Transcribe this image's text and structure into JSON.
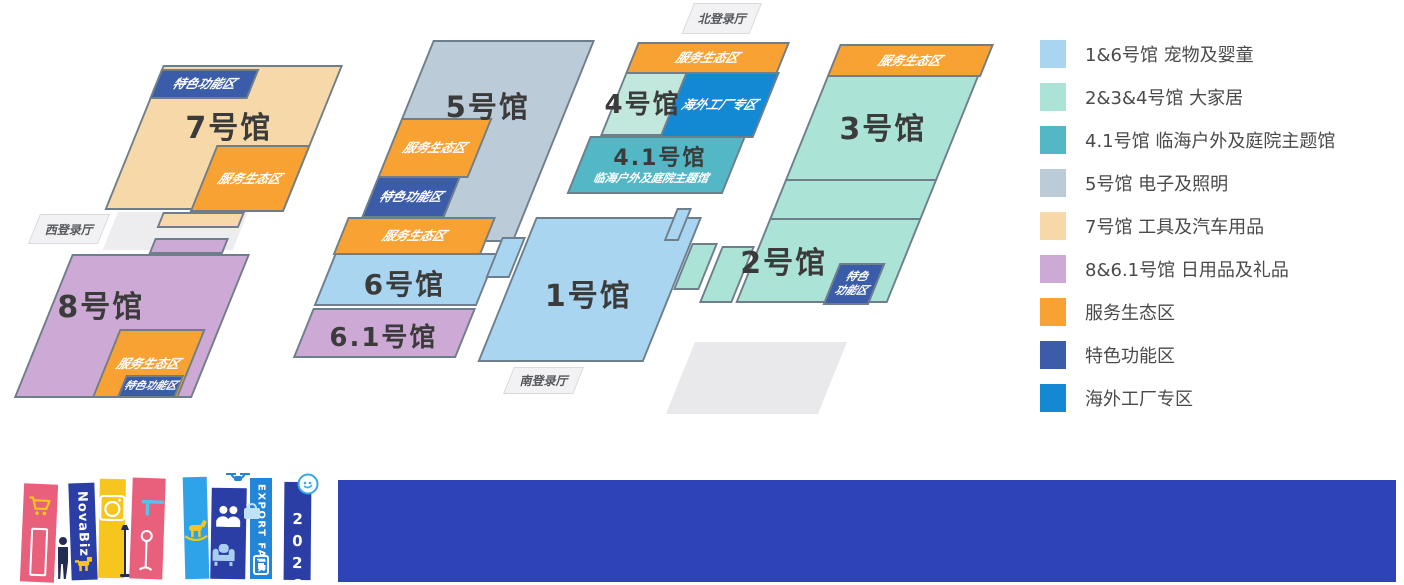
{
  "map": {
    "entrances": {
      "west": "西登录厅",
      "north": "北登录厅",
      "south": "南登录厅"
    },
    "zones": {
      "service": "服务生态区",
      "special": "特色功能区",
      "special_wrapped": "特色\n功能区",
      "overseas": "海外工厂专区"
    },
    "halls": {
      "h1": {
        "name": "1号馆"
      },
      "h2": {
        "name": "2号馆"
      },
      "h3": {
        "name": "3号馆"
      },
      "h4": {
        "name": "4号馆"
      },
      "h41": {
        "name": "4.1号馆",
        "subtitle": "临海户外及庭院主题馆"
      },
      "h5": {
        "name": "5号馆"
      },
      "h6": {
        "name": "6号馆"
      },
      "h61": {
        "name": "6.1号馆"
      },
      "h7": {
        "name": "7号馆"
      },
      "h8": {
        "name": "8号馆"
      }
    }
  },
  "legend": {
    "items": [
      {
        "swatch": "hall_blue",
        "label": "1&6号馆 宠物及婴童"
      },
      {
        "swatch": "hall_mint",
        "label": "2&3&4号馆 大家居"
      },
      {
        "swatch": "hall_teal",
        "label": "4.1号馆 临海户外及庭院主题馆"
      },
      {
        "swatch": "hall_gray",
        "label": "5号馆 电子及照明"
      },
      {
        "swatch": "hall_tan",
        "label": "7号馆 工具及汽车用品"
      },
      {
        "swatch": "hall_purple",
        "label": "8&6.1号馆 日用品及礼品"
      },
      {
        "swatch": "service_orange",
        "label": "服务生态区"
      },
      {
        "swatch": "special_blue",
        "label": "特色功能区"
      },
      {
        "swatch": "overseas_blue",
        "label": "海外工厂专区"
      }
    ]
  },
  "footer": {
    "brand": "NovaBiz",
    "fair": "EXPORT FAIR",
    "year": "2026",
    "icons": [
      "cart-icon",
      "person-icon",
      "dog-icon",
      "washing-machine-icon",
      "shelf-icon",
      "floor-lamp-icon",
      "table-lamp-icon",
      "rocking-horse-icon",
      "people-icon",
      "armchair-icon",
      "drone-icon",
      "shopping-bag-icon",
      "appliance-icon",
      "chat-logo-icon"
    ]
  },
  "colors": {
    "border": "#6F7E8B",
    "hall_blue": "#A9D5F1",
    "hall_mint": "#ABE3D6",
    "hall4_mint": "#C2E7DC",
    "hall_teal": "#54B7C6",
    "hall_gray": "#BCCBD8",
    "hall_tan": "#F7D9A9",
    "hall_purple": "#CDA9D5",
    "service_orange": "#F8A233",
    "special_blue": "#3A5CA9",
    "overseas_blue": "#1389D4",
    "entrance_bg": "#F2F2F4",
    "pad_gray": "#E9E9EB",
    "corridor_gray": "#EDEDEF",
    "footer_bar": "#2F43B8",
    "banner_pink": "#E8607C",
    "banner_yellow": "#F6C51E",
    "banner_navy": "#2B3EA6",
    "banner_skyblue": "#2FA3EA",
    "banner_blue": "#2285D8"
  }
}
